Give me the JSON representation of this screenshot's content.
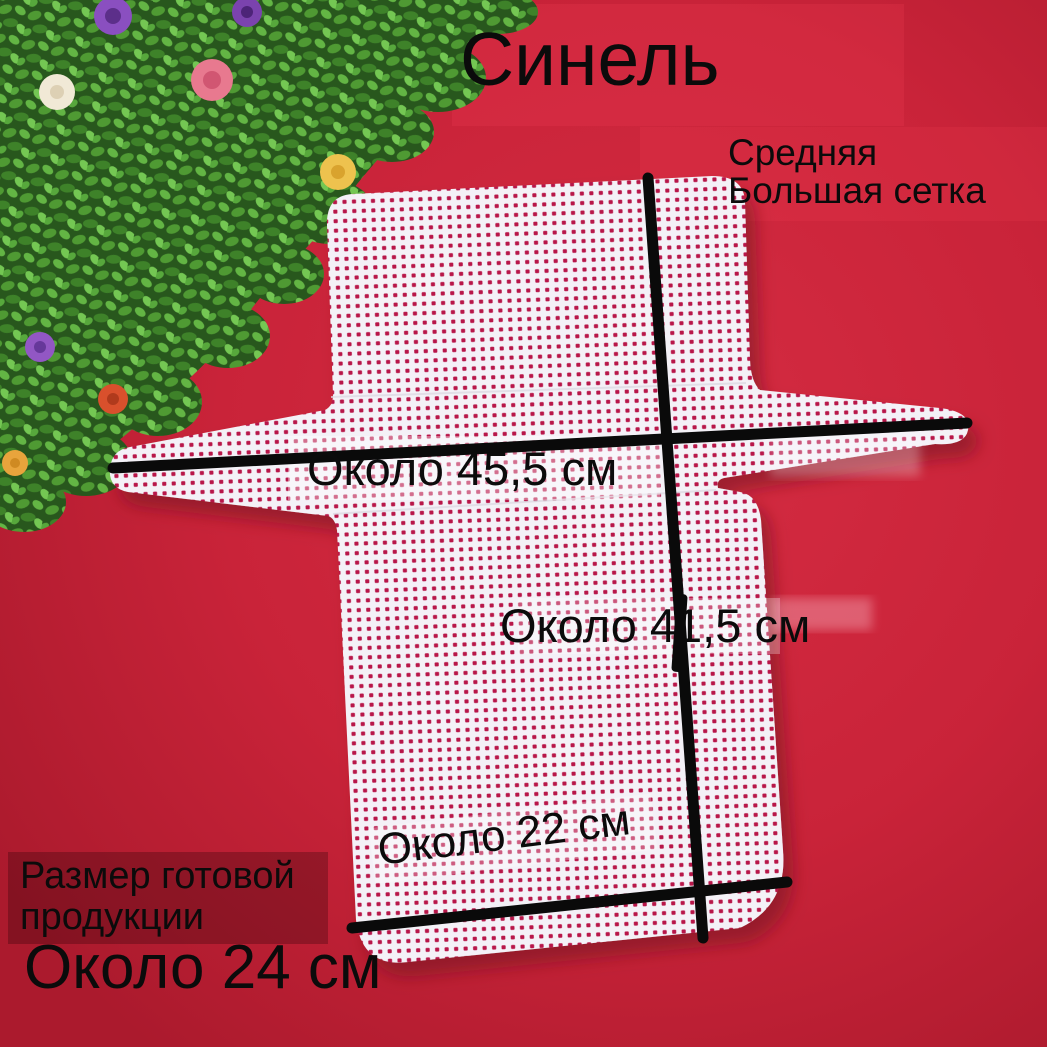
{
  "image": {
    "type": "marketplace product photo",
    "subject": "white plastic mesh canvas bag blank on red felt background"
  },
  "title": "Синель",
  "annotations": {
    "mesh_type": {
      "line1": "Средняя",
      "line2": "Большая сетка"
    },
    "width_label": "Около 45,5 см",
    "height_label": "Около 41,5 см",
    "bottom_width_label": "Около 22 см",
    "finished_size": {
      "caption_line1": "Размер готовой",
      "caption_line2": "продукции",
      "value": "Около 24 см"
    }
  },
  "colors": {
    "background_red": "#c62134",
    "mesh_white": "#f4f1f7",
    "mesh_hole_red": "#b8184a",
    "annotation_black": "#0b0b0b",
    "caption_panel_red": "#9e1a2b",
    "foliage_green": "#3e8229",
    "flower_colors": [
      "#8a4fc0",
      "#7b43ae",
      "#e8798f",
      "#f1e9d6",
      "#eec24e",
      "#9257c4",
      "#d9502c",
      "#e8a43c"
    ]
  }
}
